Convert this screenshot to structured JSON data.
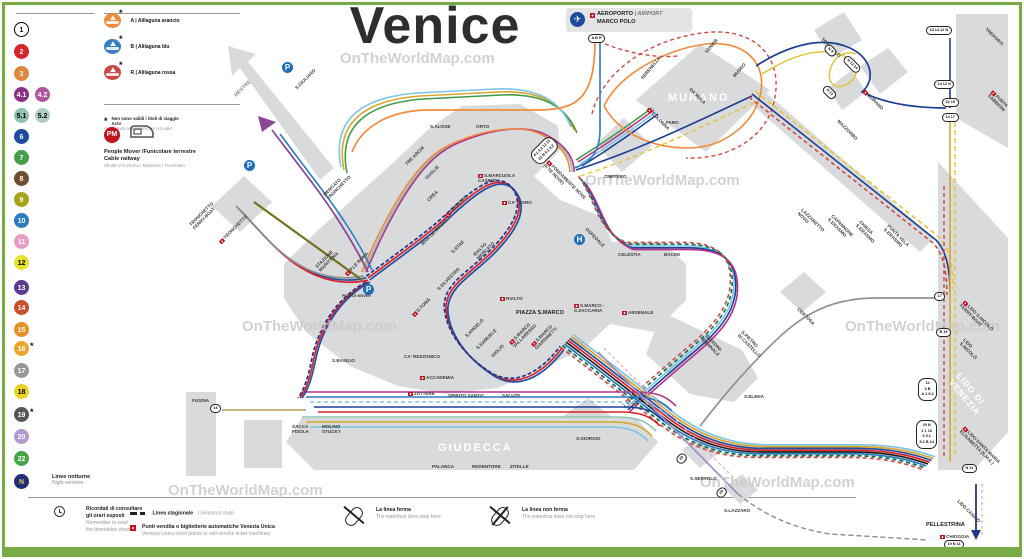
{
  "palette": {
    "frame": "#79ab45",
    "island": "#d9dadb",
    "l1": "#d9232a",
    "l2": "#2350a0",
    "black": "#231f20",
    "n": "#27348b",
    "m41": "#b5338a",
    "t51": "#8fc3b1",
    "blue6": "#1b3f94",
    "az10": "#2b7bbf",
    "cyan5": "#7fc4e3",
    "olive": "#76711c",
    "orangeA": "#f08c3b",
    "bluA": "#3a7fc2",
    "rossa": "#cf4a43",
    "yellow": "#e3c63c",
    "gold": "#d9a62e",
    "green22": "#3f9c47",
    "dgreen": "#00744f",
    "gray17": "#8f9193",
    "viol20": "#a291c8",
    "pink": "#f0a3bc",
    "tan": "#c8a96d",
    "purpleM": "#8c4799"
  },
  "title": "Venice",
  "sidebar": {
    "rows": [
      {
        "y": 22,
        "l1": "1",
        "bg1": "#ffffff",
        "fg1": "#000000",
        "bd1": "#000000"
      },
      {
        "y": 44,
        "l1": "2",
        "bg1": "#d4262c",
        "fg1": "#ffffff"
      },
      {
        "y": 66,
        "l1": "3",
        "bg1": "#e0873e",
        "fg1": "#ffffff"
      },
      {
        "y": 87,
        "l1": "4.1",
        "bg1": "#8f2e87",
        "fg1": "#ffffff",
        "l2": "4.2",
        "bg2": "#b0549c",
        "fg2": "#ffffff"
      },
      {
        "y": 108,
        "l1": "5.1",
        "bg1": "#8fbfae",
        "fg1": "#000000",
        "l2": "5.2",
        "bg2": "#aecfc0",
        "fg2": "#000000"
      },
      {
        "y": 129,
        "l1": "6",
        "bg1": "#1e4b9e",
        "fg1": "#ffffff"
      },
      {
        "y": 150,
        "l1": "7",
        "bg1": "#44a048",
        "fg1": "#ffffff"
      },
      {
        "y": 171,
        "l1": "8",
        "bg1": "#6d4f2f",
        "fg1": "#ffffff"
      },
      {
        "y": 192,
        "l1": "9",
        "bg1": "#a8a419",
        "fg1": "#ffffff"
      },
      {
        "y": 213,
        "l1": "10",
        "bg1": "#2b7bbf",
        "fg1": "#ffffff"
      },
      {
        "y": 234,
        "l1": "11",
        "bg1": "#e89cc5",
        "fg1": "#ffffff"
      },
      {
        "y": 255,
        "l1": "12",
        "bg1": "#e5e22e",
        "fg1": "#000000"
      },
      {
        "y": 280,
        "l1": "13",
        "bg1": "#5b3b8f",
        "fg1": "#ffffff"
      },
      {
        "y": 300,
        "l1": "14",
        "bg1": "#c8502d",
        "fg1": "#ffffff"
      },
      {
        "y": 322,
        "l1": "15",
        "bg1": "#e98f27",
        "fg1": "#ffffff"
      },
      {
        "y": 341,
        "l1": "16",
        "bg1": "#eca42d",
        "fg1": "#ffffff",
        "star": "*"
      },
      {
        "y": 363,
        "l1": "17",
        "bg1": "#98989a",
        "fg1": "#ffffff"
      },
      {
        "y": 384,
        "l1": "18",
        "bg1": "#e8d222",
        "fg1": "#000000"
      },
      {
        "y": 407,
        "l1": "19",
        "bg1": "#57575a",
        "fg1": "#ffffff",
        "star": "*"
      },
      {
        "y": 429,
        "l1": "20",
        "bg1": "#b39bcd",
        "fg1": "#ffffff"
      },
      {
        "y": 451,
        "l1": "22",
        "bg1": "#47a447",
        "fg1": "#ffffff"
      },
      {
        "y": 474,
        "l1": "N",
        "bg1": "#1f2d7b",
        "fg1": "#f2d23a"
      }
    ],
    "night": {
      "it": "Linee notturne",
      "en": "Night services"
    }
  },
  "legend_top": {
    "boats": [
      {
        "y": 12,
        "bc": "#ef8b3a",
        "star": "*",
        "t": "A | Alilaguna arancio"
      },
      {
        "y": 38,
        "bc": "#3a7fc2",
        "star": "*",
        "t": "B | Alilaguna blu"
      },
      {
        "y": 64,
        "bc": "#c64b44",
        "star": "*",
        "t": "R | Alilaguna rossa"
      }
    ],
    "star_note": {
      "it": "Non sono validi i titoli di viaggio Actv",
      "en": "Actv tickets and passes are not valid"
    },
    "pm": {
      "badge": "PM",
      "title1": "People Mover /Funicolare terrestre",
      "title2": "Cable railway",
      "sub": "Shuttle P.le Roma / Marittima / Tronchetto"
    }
  },
  "airport": {
    "line1": "AEROPORTO",
    "line1b": "| AIRPORT",
    "line2": "MARCO POLO"
  },
  "legend_bottom": {
    "timetable_it1": "Ricordati di consultare",
    "timetable_it2": "gli orari esposti",
    "timetable_en1": "Remember to read",
    "timetable_en2": "the timetables shown",
    "seasonal_it": "Linea stagionale",
    "seasonal_en": "| Seasonal route",
    "tickets_it": "Punti vendita o biglietterie automatiche Venezia Unica",
    "tickets_en": "Venezia Unica ticket points or self-service ticket machines",
    "stop_it": "La linea ferma",
    "stop_en": "The waterbus does stop here",
    "nostop_it": "La linea non ferma",
    "nostop_en": "The waterbus does not stop here"
  },
  "map": {
    "watermarks": [
      {
        "t": "OnTheWorldMap.com",
        "x": 340,
        "y": 50
      },
      {
        "t": "OnTheWorldMap.com",
        "x": 585,
        "y": 172
      },
      {
        "t": "OnTheWorldMap.com",
        "x": 242,
        "y": 318
      },
      {
        "t": "OnTheWorldMap.com",
        "x": 168,
        "y": 482
      },
      {
        "t": "OnTheWorldMap.com",
        "x": 700,
        "y": 474
      },
      {
        "t": "OnTheWorldMap.com",
        "x": 845,
        "y": 318
      }
    ],
    "labels": [
      {
        "t": "MESTRE",
        "x": 236,
        "y": 94,
        "r": -45,
        "k": "road"
      },
      {
        "t": "S.GIULIANO",
        "x": 296,
        "y": 86,
        "r": -45
      },
      {
        "t": "TRONCHETTO",
        "t2": "FERRY-BOAT",
        "x": 192,
        "y": 222,
        "r": -45
      },
      {
        "t": "TRONCHETTO",
        "x": 220,
        "y": 240,
        "r": -45,
        "f": 1
      },
      {
        "t": "MERCATO",
        "t2": "TRONCHETTO",
        "x": 326,
        "y": 192,
        "r": -45
      },
      {
        "t": "STAZIONE",
        "t2": "MARITTIMA",
        "x": 318,
        "y": 264,
        "r": -45
      },
      {
        "t": "P.LE ROMA",
        "x": 346,
        "y": 272,
        "r": -45,
        "f": 1
      },
      {
        "t": "PEOPLE MOVER",
        "x": 342,
        "y": 294,
        "k": "tiny"
      },
      {
        "t": "FERROVIA",
        "x": 446,
        "y": 214,
        "r": -45,
        "f": 1
      },
      {
        "t": "RIVA DE BIASIO",
        "x": 422,
        "y": 242,
        "r": -45
      },
      {
        "t": "S.STAE",
        "x": 452,
        "y": 250,
        "r": -45
      },
      {
        "t": "S.MARCUOLA",
        "t2": "CASINÒ",
        "x": 478,
        "y": 173,
        "f": 1
      },
      {
        "t": "CA' D'ORO",
        "x": 502,
        "y": 200,
        "f": 1
      },
      {
        "t": "RIALTO",
        "t2": "MERCATO",
        "x": 476,
        "y": 252,
        "r": -45
      },
      {
        "t": "RIALTO",
        "x": 500,
        "y": 296,
        "f": 1
      },
      {
        "t": "S.SILVESTRO",
        "x": 438,
        "y": 287,
        "r": -45
      },
      {
        "t": "S.TOMÀ",
        "x": 413,
        "y": 313,
        "r": -45,
        "f": 1
      },
      {
        "t": "S.ANGELO",
        "x": 466,
        "y": 334,
        "r": -45
      },
      {
        "t": "S.SAMUELE",
        "x": 477,
        "y": 346,
        "r": -45
      },
      {
        "t": "GIGLIO",
        "x": 492,
        "y": 354,
        "r": -45
      },
      {
        "t": "CA' REZZONICO",
        "x": 404,
        "y": 354
      },
      {
        "t": "ACCADEMIA",
        "x": 420,
        "y": 375,
        "f": 1
      },
      {
        "t": "SALUTE",
        "x": 502,
        "y": 393
      },
      {
        "t": "ZATTERE",
        "x": 408,
        "y": 391,
        "f": 1
      },
      {
        "t": "SPIRITO SANTO",
        "x": 448,
        "y": 393
      },
      {
        "t": "S.BASILIO",
        "x": 332,
        "y": 358
      },
      {
        "t": "SACCA",
        "t2": "FISOLA",
        "x": 292,
        "y": 424
      },
      {
        "t": "MOLINO",
        "t2": "STUCKY",
        "x": 322,
        "y": 424
      },
      {
        "t": "PALANCA",
        "x": 432,
        "y": 464
      },
      {
        "t": "REDENTORE",
        "x": 472,
        "y": 464
      },
      {
        "t": "ZITELLE",
        "x": 510,
        "y": 464
      },
      {
        "t": "GIUDECCA",
        "x": 438,
        "y": 442,
        "k": "island"
      },
      {
        "t": "FUSINA",
        "x": 192,
        "y": 398
      },
      {
        "t": "TRE ARCHI",
        "x": 406,
        "y": 162,
        "r": -45
      },
      {
        "t": "GUGLIE",
        "x": 426,
        "y": 176,
        "r": -45
      },
      {
        "t": "CREA",
        "x": 428,
        "y": 198,
        "r": -45
      },
      {
        "t": "S.ALVISE",
        "x": 430,
        "y": 124
      },
      {
        "t": "ORTO",
        "x": 476,
        "y": 124
      },
      {
        "t": "FONDAMENTE NOVE",
        "t2": "(F.TE NOVE)",
        "x": 546,
        "y": 158,
        "r": 45,
        "f": 1
      },
      {
        "t": "CIMITERO",
        "x": 604,
        "y": 174
      },
      {
        "t": "OSPEDALE",
        "x": 586,
        "y": 226,
        "r": 45
      },
      {
        "t": "CELESTIA",
        "x": 618,
        "y": 252
      },
      {
        "t": "BACINI",
        "x": 664,
        "y": 252
      },
      {
        "t": "MURANO",
        "x": 668,
        "y": 92,
        "k": "island"
      },
      {
        "t": "COLONNA",
        "x": 648,
        "y": 106,
        "r": 45,
        "f": 1
      },
      {
        "t": "FARO",
        "x": 666,
        "y": 120
      },
      {
        "t": "SERENELLA",
        "x": 642,
        "y": 76,
        "r": -50
      },
      {
        "t": "DA MULA",
        "x": 690,
        "y": 86,
        "r": 45
      },
      {
        "t": "VENIER",
        "x": 706,
        "y": 50,
        "r": -50
      },
      {
        "t": "MUSEO",
        "x": 734,
        "y": 74,
        "r": -50
      },
      {
        "t": "TORCELLO",
        "x": 822,
        "y": 36,
        "r": 45
      },
      {
        "t": "BURANO",
        "x": 864,
        "y": 88,
        "r": 45,
        "f": 1
      },
      {
        "t": "MAZZORBO",
        "x": 838,
        "y": 118,
        "r": 45
      },
      {
        "t": "LAZZARETTO",
        "t2": "NOVO",
        "x": 800,
        "y": 206,
        "r": 45
      },
      {
        "t": "CAPANNONE",
        "t2": "S.ERASMO",
        "x": 830,
        "y": 212,
        "r": 45
      },
      {
        "t": "CHIESA",
        "t2": "S.ERASMO",
        "x": 858,
        "y": 218,
        "r": 45
      },
      {
        "t": "PUNTA VELA",
        "t2": "S.ERASMO",
        "x": 886,
        "y": 222,
        "r": 45
      },
      {
        "t": "TREPORTI",
        "x": 986,
        "y": 26,
        "r": 45
      },
      {
        "t": "PUNTA",
        "t2": "SABBIONI",
        "x": 990,
        "y": 88,
        "r": 45,
        "f": 1
      },
      {
        "t": "CERTOSA",
        "x": 798,
        "y": 306,
        "r": 45
      },
      {
        "t": "S.PIETRO",
        "t2": "DI CASTELLO",
        "x": 740,
        "y": 328,
        "r": 45
      },
      {
        "t": "GIARDINI-",
        "t2": "BIENNALE",
        "x": 704,
        "y": 332,
        "r": 45
      },
      {
        "t": "S.ELENA",
        "x": 744,
        "y": 394
      },
      {
        "t": "S.GIORGIO",
        "x": 576,
        "y": 436
      },
      {
        "t": "S.SERVOLO",
        "x": 690,
        "y": 476
      },
      {
        "t": "S.LAZZARO",
        "x": 724,
        "y": 508
      },
      {
        "t": "PIAZZA S.MARCO",
        "x": 516,
        "y": 310,
        "k": "bold"
      },
      {
        "t": "S.MARCO",
        "t2": "VALLARESSO",
        "x": 512,
        "y": 340,
        "r": -45,
        "f": 1
      },
      {
        "t": "S.MARCO",
        "t2": "GIARDINETTI",
        "x": 534,
        "y": 342,
        "r": -45,
        "f": 1
      },
      {
        "t": "S.MARCO -",
        "t2": "S.ZACCARIA",
        "x": 574,
        "y": 303,
        "f": 1
      },
      {
        "t": "ARSENALE",
        "x": 622,
        "y": 310,
        "f": 1
      },
      {
        "t": "LIDO S.NICOLÒ",
        "t2": "FERRY-BOAT",
        "x": 962,
        "y": 298,
        "r": 45,
        "f": 1
      },
      {
        "t": "LIDO",
        "t2": "S.NICOLÒ",
        "x": 962,
        "y": 336,
        "r": 45
      },
      {
        "t": "LIDO DI",
        "t2": "VENEZIA",
        "x": 954,
        "y": 368,
        "r": 50,
        "k": "islandsm"
      },
      {
        "t": "LIDO SANTA MARIA",
        "t2": "ELISABETTA (S.M.E.)",
        "x": 962,
        "y": 424,
        "r": 45,
        "f": 1
      },
      {
        "t": "LIDO CASINÒ",
        "x": 958,
        "y": 498,
        "r": 45
      },
      {
        "t": "PELLESTRINA",
        "x": 926,
        "y": 522,
        "k": "bold"
      },
      {
        "t": "CHIOGGIA",
        "x": 940,
        "y": 534,
        "f": 1
      }
    ],
    "capsules": [
      {
        "t": "A B R",
        "x": 588,
        "y": 34
      },
      {
        "t": "13 14 12 N",
        "x": 926,
        "y": 26
      },
      {
        "t": "14 12 N",
        "x": 934,
        "y": 80
      },
      {
        "t": "22 15",
        "x": 942,
        "y": 98
      },
      {
        "t": "14 17",
        "x": 942,
        "y": 113
      },
      {
        "t": "N 9",
        "x": 824,
        "y": 46,
        "r": 45
      },
      {
        "t": "N 12 14",
        "x": 842,
        "y": 60,
        "r": 45
      },
      {
        "t": "N 12",
        "x": 822,
        "y": 88,
        "r": 45
      },
      {
        "t": "4.1 4.2 12 13\n22 N 5.1 5.2",
        "x": 530,
        "y": 142,
        "r": -45,
        "big": 1
      },
      {
        "t": "17",
        "x": 934,
        "y": 292
      },
      {
        "t": "B 19",
        "x": 936,
        "y": 328
      },
      {
        "t": "14\n6 B\nA 1 5.2",
        "x": 918,
        "y": 378,
        "big": 1
      },
      {
        "t": "20 N\n2 1 10\n6 5.1\n5.2 B 14",
        "x": 916,
        "y": 420,
        "big": 1
      },
      {
        "t": "16",
        "x": 210,
        "y": 404
      },
      {
        "t": "20",
        "x": 676,
        "y": 454,
        "r": -45
      },
      {
        "t": "20",
        "x": 716,
        "y": 488,
        "r": -45
      },
      {
        "t": "N 11",
        "x": 962,
        "y": 464
      },
      {
        "t": "19 N 11",
        "x": 944,
        "y": 540
      }
    ],
    "icons": [
      {
        "type": "parking",
        "x": 282,
        "y": 62,
        "g": "P"
      },
      {
        "type": "bus",
        "x": 258,
        "y": 88
      },
      {
        "type": "parking",
        "x": 244,
        "y": 160,
        "g": "P"
      },
      {
        "type": "pm-dot",
        "x": 248,
        "y": 196
      },
      {
        "type": "pm-dot",
        "x": 358,
        "y": 274
      },
      {
        "type": "bus",
        "x": 340,
        "y": 285
      },
      {
        "type": "tram",
        "x": 352,
        "y": 285
      },
      {
        "type": "parking",
        "x": 363,
        "y": 284,
        "g": "P"
      },
      {
        "type": "hospital",
        "x": 574,
        "y": 234,
        "g": "H"
      },
      {
        "type": "basilica",
        "x": 528,
        "y": 299
      },
      {
        "type": "ship",
        "x": 912,
        "y": 292
      },
      {
        "type": "bus",
        "x": 934,
        "y": 468
      }
    ]
  }
}
